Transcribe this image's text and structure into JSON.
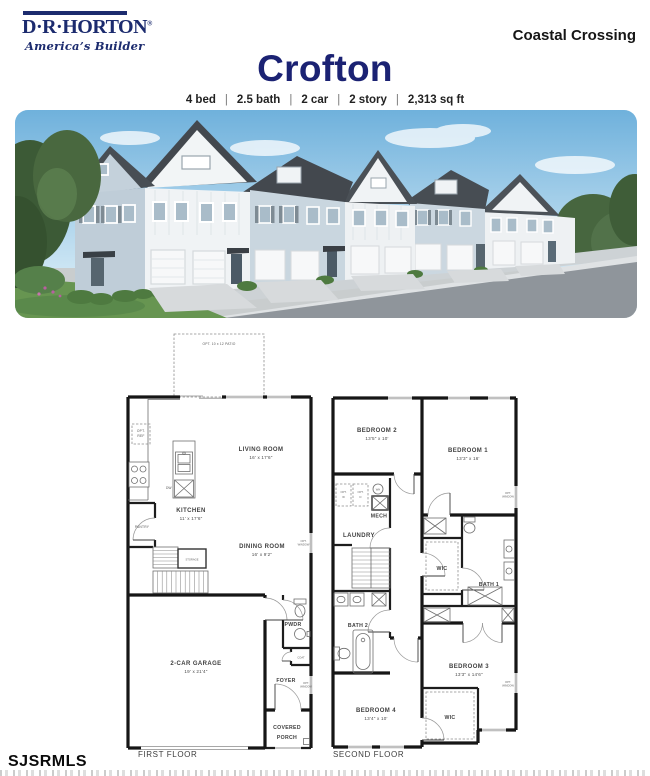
{
  "header": {
    "brand": "D·R·HORTON",
    "registered": "®",
    "tagline": "America’s Builder",
    "community": "Coastal Crossing",
    "plan_name": "Crofton",
    "specs": {
      "s0": "4 bed",
      "s1": "2.5 bath",
      "s2": "2 car",
      "s3": "2 story",
      "s4": "2,313 sq ft",
      "sep": "|"
    }
  },
  "photo": {
    "description": "Street-scene rendering of two-story townhomes with white and light blue-gray siding, gray gable roofs, white two-car garage doors, lawn, trees and street"
  },
  "floor1": {
    "title": "FIRST FLOOR",
    "patio": "OPT. 10 x 12 PATIO",
    "living": "LIVING ROOM",
    "living_d": "16' x 17'6\"",
    "kitchen": "KITCHEN",
    "kitchen_d": "11' x 17'6\"",
    "dining": "DINING ROOM",
    "dining_d": "16' x 9'2\"",
    "garage": "2-CAR GARAGE",
    "garage_d": "19' x 21'4\"",
    "pwdr": "PWDR",
    "foyer": "FOYER",
    "covered": "COVERED",
    "porch": "PORCH",
    "pantry": "PANTRY",
    "storage": "STORAGE",
    "coat": "COAT",
    "opt_ref_a": "OPT.",
    "opt_ref_b": "REF",
    "dw": "DW",
    "opt_a": "OPT.",
    "opt_b": "WINDOW"
  },
  "floor2": {
    "title": "SECOND FLOOR",
    "bed1": "BEDROOM 1",
    "bed1_d": "13'3\" x 16'",
    "bed2": "BEDROOM 2",
    "bed2_d": "13'5\" x 10'",
    "bed3": "BEDROOM 3",
    "bed3_d": "13'3\" x 14'6\"",
    "bed4": "BEDROOM 4",
    "bed4_d": "13'4\" x 10'",
    "laundry": "LAUNDRY",
    "mech": "MECH",
    "bath1": "BATH 1",
    "bath2": "BATH 2",
    "wic": "WIC",
    "opt_w_a": "OPT.",
    "opt_w_b": "W",
    "opt_d_a": "OPT.",
    "opt_d_b": "D",
    "wh": "WH",
    "opt_a": "OPT.",
    "opt_b": "WINDOW"
  },
  "watermark": "SJSRMLS",
  "colors": {
    "brand_navy": "#1c2b6e",
    "title_blue": "#1b2273",
    "text_dark": "#222222",
    "sky": "#87bfe3",
    "roof": "#4c5258",
    "siding_blue": "#c7d4de",
    "siding_white": "#f0f3f5",
    "grass": "#679551",
    "road": "#8f959b",
    "plan_line": "#161616"
  }
}
